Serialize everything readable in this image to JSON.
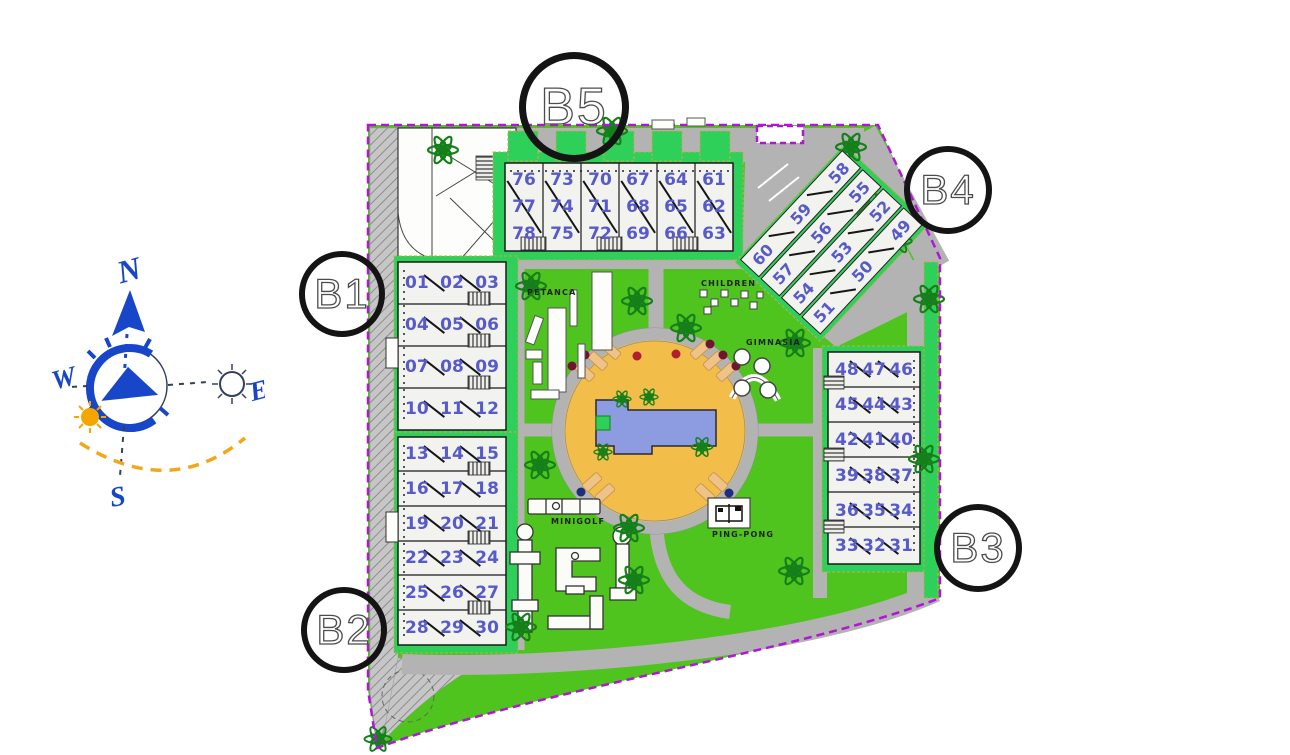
{
  "buildings": [
    {
      "id": "b1",
      "label": "B1",
      "units": [
        [
          "01",
          "02",
          "03"
        ],
        [
          "04",
          "05",
          "06"
        ],
        [
          "07",
          "08",
          "09"
        ],
        [
          "10",
          "11",
          "12"
        ]
      ]
    },
    {
      "id": "b2",
      "label": "B2",
      "units": [
        [
          "13",
          "14",
          "15"
        ],
        [
          "16",
          "17",
          "18"
        ],
        [
          "19",
          "20",
          "21"
        ],
        [
          "22",
          "23",
          "24"
        ],
        [
          "25",
          "26",
          "27"
        ],
        [
          "28",
          "29",
          "30"
        ]
      ]
    },
    {
      "id": "b3",
      "label": "B3",
      "units": [
        [
          "48",
          "47",
          "46"
        ],
        [
          "45",
          "44",
          "43"
        ],
        [
          "42",
          "41",
          "40"
        ],
        [
          "39",
          "38",
          "37"
        ],
        [
          "36",
          "35",
          "34"
        ],
        [
          "33",
          "32",
          "31"
        ]
      ]
    },
    {
      "id": "b4",
      "label": "B4",
      "units": [
        [
          "60",
          "59",
          "58"
        ],
        [
          "57",
          "56",
          "55"
        ],
        [
          "54",
          "53",
          "52"
        ],
        [
          "51",
          "50",
          "49"
        ]
      ]
    },
    {
      "id": "b5",
      "label": "B5",
      "units": [
        [
          "76",
          "77",
          "78"
        ],
        [
          "73",
          "74",
          "75"
        ],
        [
          "70",
          "71",
          "72"
        ],
        [
          "67",
          "68",
          "69"
        ],
        [
          "64",
          "65",
          "66"
        ],
        [
          "61",
          "62",
          "63"
        ]
      ]
    }
  ],
  "amenities": {
    "petanca": "PETANCA",
    "children": "CHILDREN",
    "gimnasia": "GIMNASIA",
    "minigolf": "MINIGOLF",
    "pingpong": "PING-PONG"
  },
  "compass": {
    "north": "N",
    "south": "S",
    "east": "E",
    "west": "W"
  },
  "colors": {
    "lawn": "#4fc31e",
    "garden_strip": "#2fd05a",
    "road": "#b3b3b3",
    "boundary": "#b116d6",
    "pool_deck": "#f2bd49",
    "pool_water": "#8d9ce0",
    "unit_number": "#575ac9",
    "compass_blue": "#1747c8",
    "sun_orange": "#f5a500"
  }
}
